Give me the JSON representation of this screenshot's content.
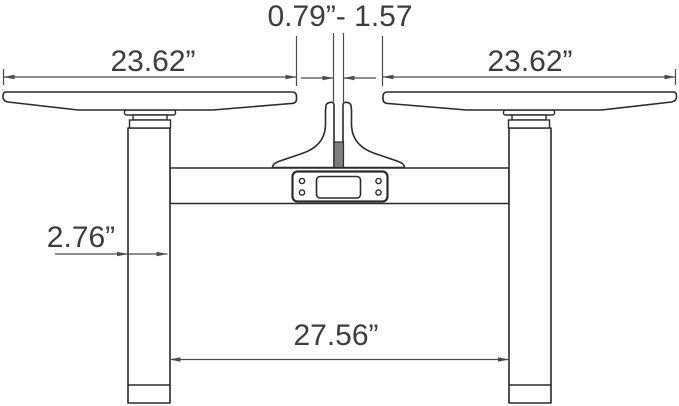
{
  "canvas": {
    "width": 679,
    "height": 406,
    "background": "#ffffff"
  },
  "colors": {
    "bg": "#ffffff",
    "line": "#2b2b2b",
    "dim": "#4a4a4a",
    "text": "#3d3d3d",
    "gap": "#7d7d7d"
  },
  "dimensions": {
    "top_gap": {
      "label": "0.79”- 1.57"
    },
    "left_tabletop_width": {
      "label": "23.62”"
    },
    "right_tabletop_width": {
      "label": "23.62”"
    },
    "leg_width": {
      "label": "2.76”"
    },
    "inner_leg_span": {
      "label": "27.56”"
    }
  },
  "parts": [
    "left-tabletop",
    "right-tabletop",
    "left-leg",
    "right-leg",
    "crossbeam",
    "center-bracket",
    "control-keypad"
  ]
}
